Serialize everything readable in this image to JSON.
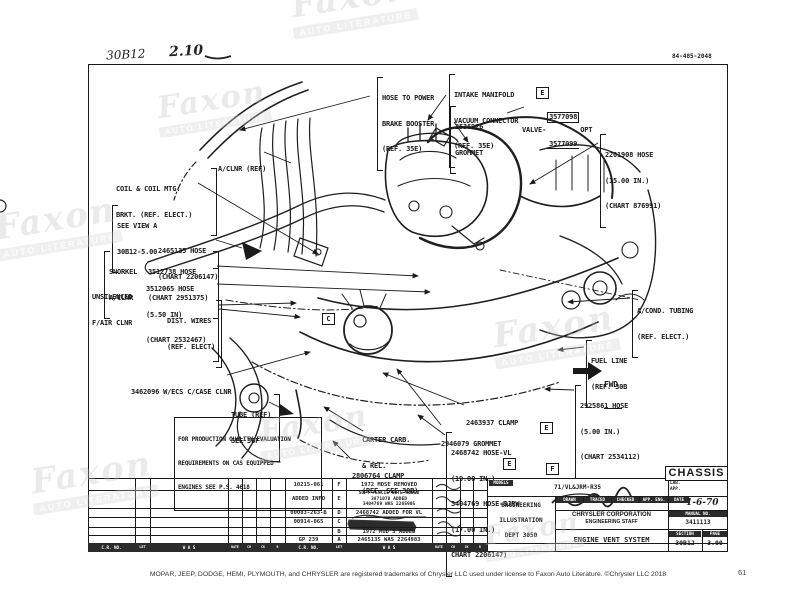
{
  "header": {
    "handwritten_section": "30B12",
    "handwritten_page": "2.10",
    "doc_number": "84-485-2048"
  },
  "watermark": {
    "big": "Faxon",
    "small": "AUTO LITERATURE"
  },
  "labels": {
    "power_brake": {
      "lines": [
        "HOSE TO POWER",
        "BRAKE BOOSTER",
        "(REF. 35E)"
      ]
    },
    "intake": {
      "lines": [
        "INTAKE MANIFOLD",
        "VACUUM CONNECTOR",
        "(REF. 35E)"
      ]
    },
    "grommet_2536926": {
      "lines": [
        "2536926",
        "GROMMET"
      ]
    },
    "valve": {
      "prefix": "VALVE-",
      "num_top": "3577098",
      "num_bottom": "3577099",
      "suffix": "OPT"
    },
    "hose_2201908": {
      "lines": [
        "2201908 HOSE",
        "(15.00 IN.)",
        "(CHART 876991)"
      ]
    },
    "aclnr": {
      "lines": [
        "A/CLNR (REF)"
      ]
    },
    "coil": {
      "lines": [
        "COIL & COIL MTG.",
        "BRKT. (REF. ELECT.)"
      ]
    },
    "see_view": {
      "lines": [
        "SEE VIEW A",
        "30B12-5.00"
      ]
    },
    "hose_2465135": {
      "lines": [
        "2465135 HOSE",
        "(CHART 2206147)"
      ]
    },
    "snorkel": {
      "lines": [
        "SNORKEL",
        "A/CLNR"
      ]
    },
    "hose_3512738": {
      "lines": [
        "3512738 HOSE",
        "(CHART 2951375)"
      ]
    },
    "hose_3512065": {
      "lines": [
        "3512065 HOSE",
        "(5.50 IN)",
        "(CHART 2532467)"
      ]
    },
    "unsilenced": {
      "lines": [
        "UNSILENCED",
        "F/AIR CLNR"
      ]
    },
    "dist_wires": {
      "lines": [
        "DIST. WIRES",
        "(REF. ELECT)"
      ]
    },
    "wecs": {
      "lines": [
        "3462096 W/ECS C/CASE CLNR"
      ]
    },
    "tube": {
      "lines": [
        "TUBE (REF)",
        "SEE 36F"
      ]
    },
    "carter": {
      "lines": [
        "CARTER CARB.",
        "& REL.",
        "(REF. SEE 30B)"
      ]
    },
    "clamp_2806764": {
      "lines": [
        "2806764 CLAMP"
      ]
    },
    "clamp_2463937": {
      "lines": [
        "2463937 CLAMP"
      ]
    },
    "grommet_2946079": {
      "lines": [
        "2946079 GROMMET"
      ]
    },
    "hose_2468742": {
      "lines": [
        "2468742 HOSE-VL",
        "(19.00 IN.)",
        "3404769 HOSE-BJRW",
        "(17.00 IN.)",
        "CHART 2206147)"
      ]
    },
    "acond": {
      "lines": [
        "A/COND. TUBING",
        "(REF. ELECT.)"
      ]
    },
    "fuel": {
      "lines": [
        "FUEL LINE",
        "(REF. 30B"
      ]
    },
    "fwd": {
      "lines": [
        "FWD"
      ]
    },
    "hose_2925861": {
      "lines": [
        "2925861 HOSE",
        "(5.00 IN.)",
        "(CHART 2534112)"
      ]
    }
  },
  "note_box": {
    "lines": [
      "FOR PRODUCTION QUALITY EVALUATION",
      "REQUIREMENTS ON CAS EQUIPPED",
      "ENGINES SEE P.S. 4618"
    ]
  },
  "markers": {
    "m1": "E",
    "m2": "C",
    "m3": "E",
    "m4": "E",
    "m5": "F"
  },
  "revision_table": {
    "rows": {
      "f": {
        "cr_no": "10215-061",
        "letter": "F",
        "was": "1972 MDSE REMOVED"
      },
      "e": {
        "cr_no": "ADDED INFO",
        "letter": "E",
        "was_lines": [
          "SOFT PENCIL NOTE ADDED",
          "3871078 ADDED",
          "3404769 WAS 2265905"
        ]
      },
      "d": {
        "cr_no": "00083-263-B",
        "letter": "D",
        "was": "2468742 ADDED FOR VL"
      },
      "c": {
        "cr_no": "00914-065",
        "letter": "C"
      },
      "b": {
        "letter": "B",
        "was": "1972 MOD'S ADDED"
      },
      "a": {
        "cr_no": "GP 239",
        "letter": "A",
        "was": "2465135 WAS 2264983"
      }
    },
    "footer_left": [
      "C.R. NO.",
      "LET",
      "W A S"
    ],
    "footer_mid": [
      "DATE",
      "CH",
      "CK",
      "R"
    ],
    "footer_right": [
      "C.R. NO.",
      "LET",
      "W A S"
    ]
  },
  "title_block": {
    "chassis": "CHASSIS",
    "models_label": "MODELS",
    "models_value": "71/VL&JRM-R35",
    "lab_app_lines": [
      "LAB.",
      "APP."
    ],
    "dept_lines": [
      "ENGINEERING",
      "ILLUSTRATION",
      "DEPT 3050"
    ],
    "sig_headers": [
      "DRAWN",
      "TRACED",
      "CHECKED",
      "APP. ENG."
    ],
    "corp_lines": [
      "CHRYSLER CORPORATION",
      "ENGINEERING STAFF"
    ],
    "drawing_title": "ENGINE VENT SYSTEM",
    "date_label": "DATE",
    "date_value": "1-6-70",
    "manual_label": "MANUAL NO.",
    "manual_value": "3411113",
    "section_label": "SECTION",
    "section_value": "30B12",
    "page_label": "PAGE",
    "page_value": "3.00"
  },
  "footer": {
    "trademark": "MOPAR, JEEP, DODGE, HEMI, PLYMOUTH, and CHRYSLER are registered trademarks of Chrysler LLC used under license to Faxon Auto Literature. ©Chrysler LLC 2018",
    "page_number": "61"
  }
}
